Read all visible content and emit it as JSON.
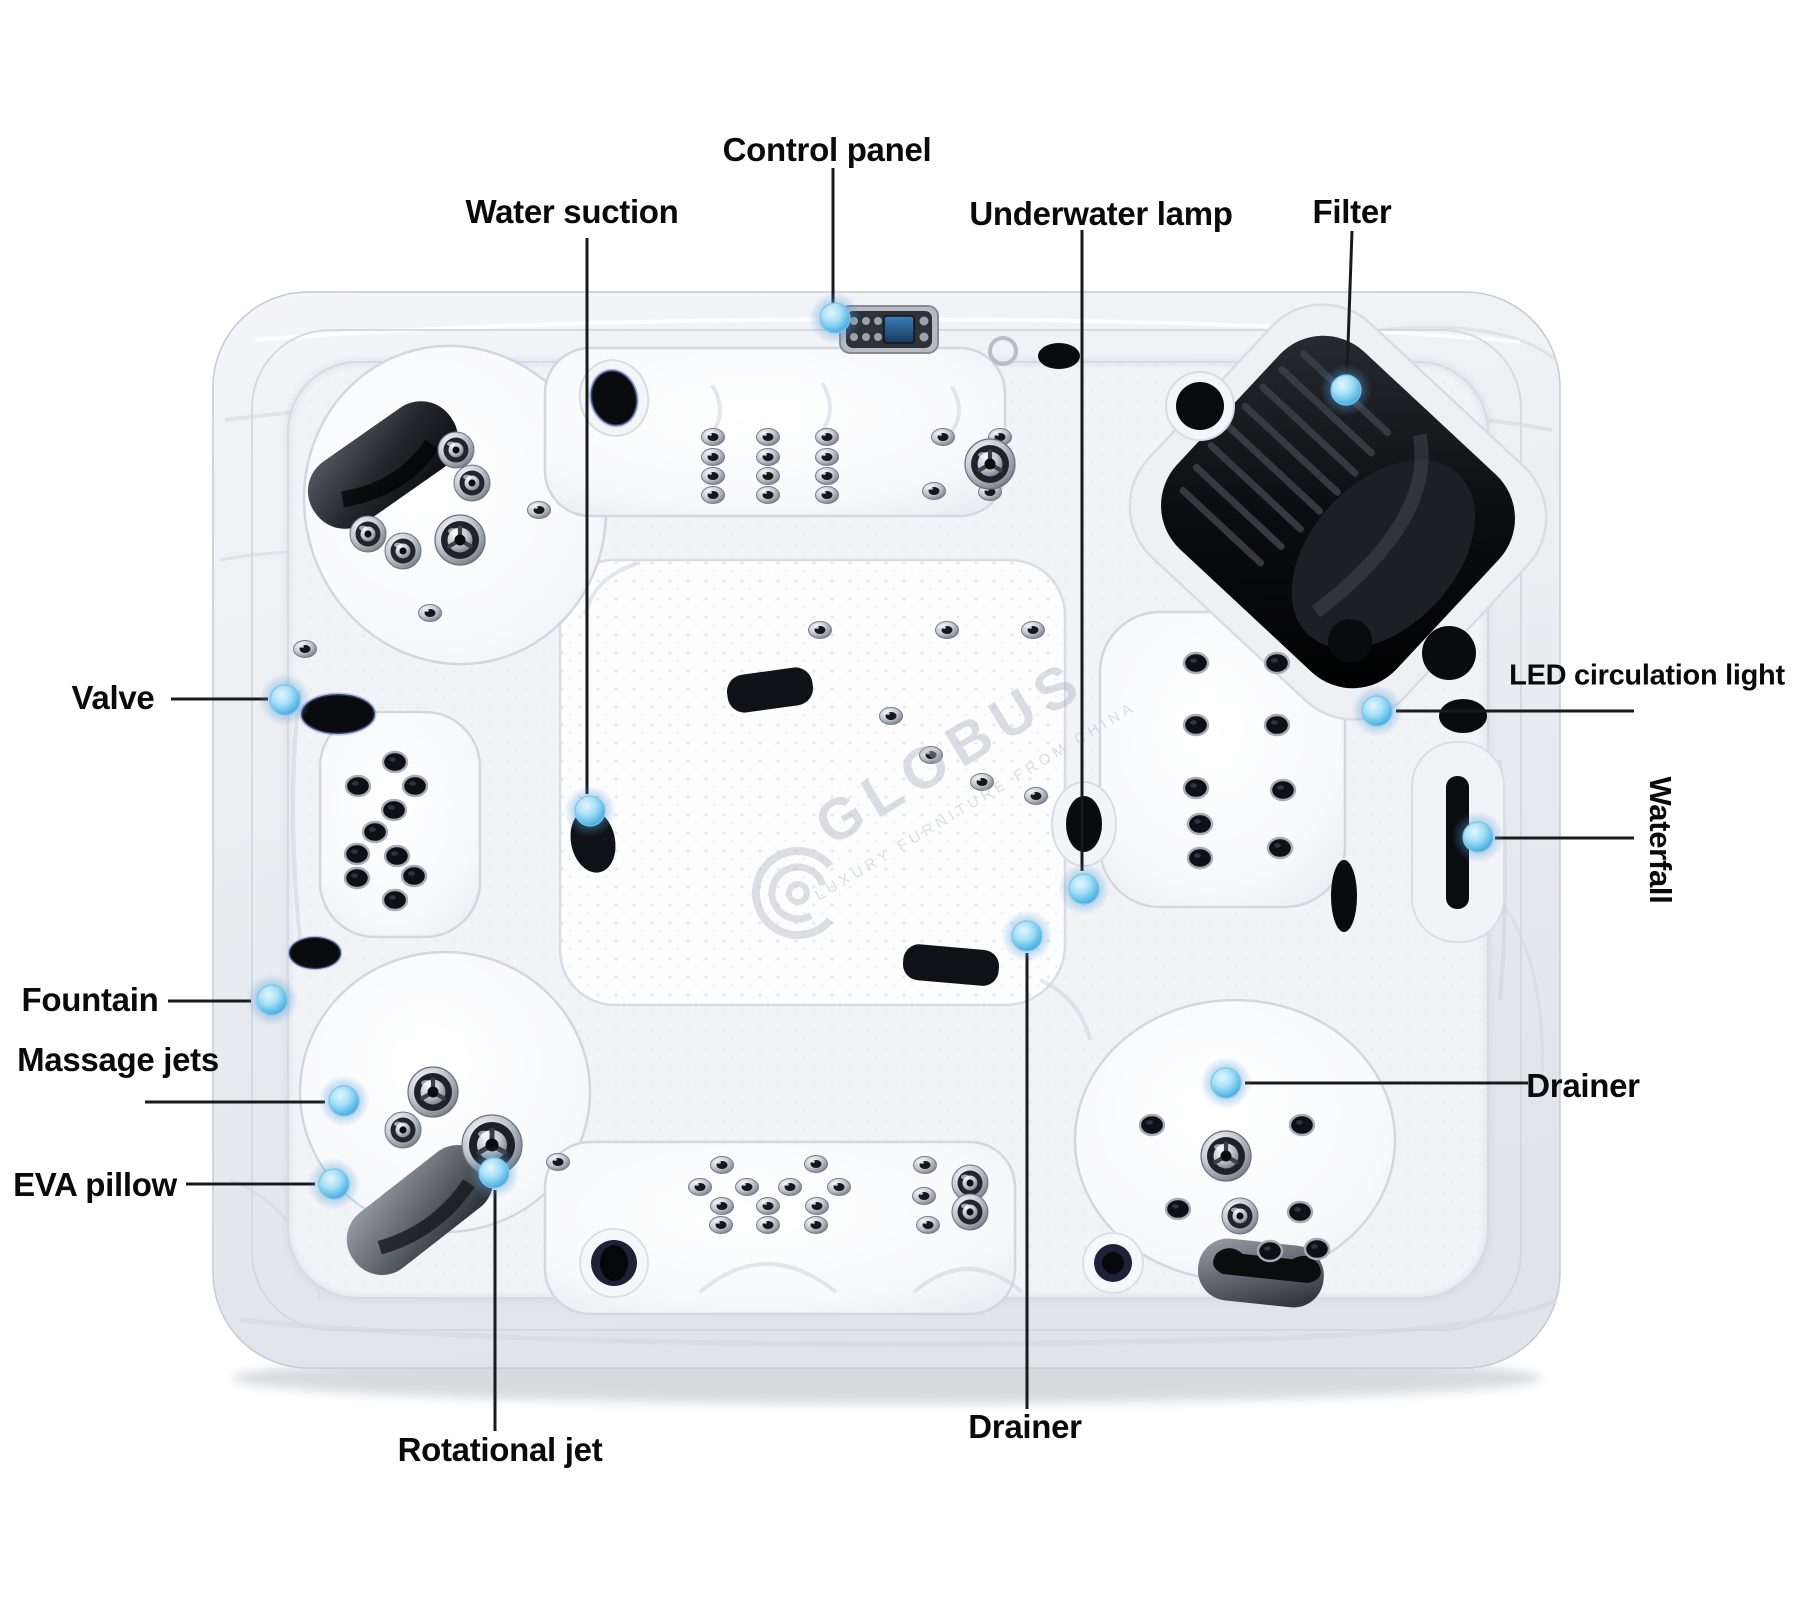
{
  "figure": {
    "subject": "hot tub top view parts diagram"
  },
  "callouts": {
    "control_panel": {
      "label": "Control panel"
    },
    "water_suction": {
      "label": "Water suction"
    },
    "underwater_lamp": {
      "label": "Underwater lamp"
    },
    "filter": {
      "label": "Filter"
    },
    "valve": {
      "label": "Valve"
    },
    "led_circulation_light": {
      "label": "LED circulation light"
    },
    "waterfall": {
      "label": "Waterfall"
    },
    "fountain": {
      "label": "Fountain"
    },
    "massage_jets": {
      "label": "Massage jets"
    },
    "eva_pillow": {
      "label": "EVA pillow"
    },
    "drainer_right": {
      "label": "Drainer"
    },
    "drainer_bottom": {
      "label": "Drainer"
    },
    "rotational_jet": {
      "label": "Rotational jet"
    }
  },
  "watermark": {
    "brand": "GLOBUS",
    "tagline": "LUXURY FURNITURE FROM CHINA"
  },
  "colors": {
    "marker_blue": "#58b7e7",
    "leader_line": "#1a1a1a",
    "label_text": "#0a0a0a",
    "shell_light": "#f2f3f6",
    "shell_dark": "#e3e6ec",
    "pillow_dark": "#23262c",
    "pillow_gray": "#5d626a",
    "screen_blue": "#2a5f94"
  }
}
